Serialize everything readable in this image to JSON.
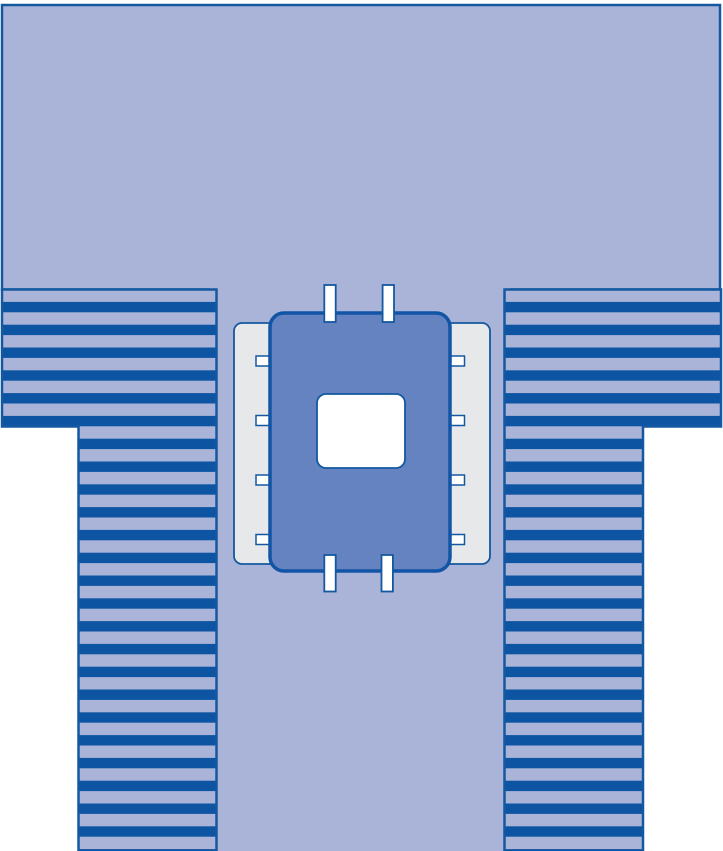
{
  "figure": {
    "title": "Fenestrated surgical drape illustration",
    "kind": "medical-product-diagram",
    "components": [
      {
        "name": "drape-top-body",
        "label": "main drape sheet (upper body)"
      },
      {
        "name": "drape-center-column",
        "label": "main drape sheet (center column)"
      },
      {
        "name": "pleated-fold-left",
        "label": "pleated side fold, striped"
      },
      {
        "name": "pleated-fold-right",
        "label": "pleated side fold, striped"
      },
      {
        "name": "tape-strip-left",
        "label": "lateral tape strip"
      },
      {
        "name": "tape-strip-right",
        "label": "lateral tape strip"
      },
      {
        "name": "reinforcement-panel",
        "label": "central reinforcement panel"
      },
      {
        "name": "fenestration",
        "label": "fenestration opening"
      }
    ],
    "tab_counts": {
      "top": 2,
      "bottom": 2,
      "left_side": 4,
      "right_side": 4
    }
  },
  "colors": {
    "page_bg": "#ffffff",
    "drape": "#a9b4d8",
    "outline": "#1458a1",
    "stripe": "#0d55a3",
    "panel": "#6583c1",
    "panel_outline": "#1254a5",
    "tape": "#e7e8ea",
    "white": "#ffffff"
  }
}
